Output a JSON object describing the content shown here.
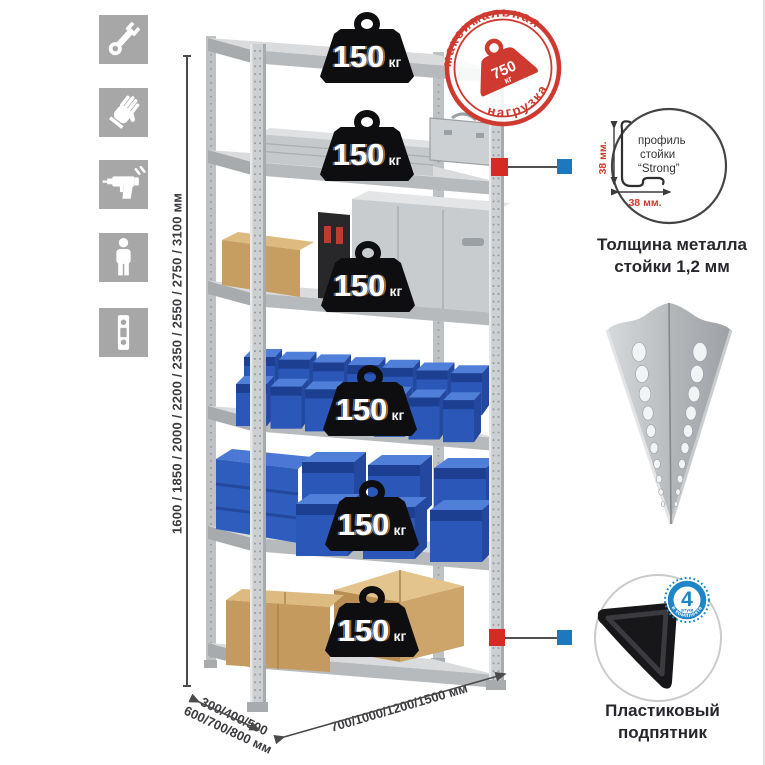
{
  "left_toolbar": {
    "icons": [
      "wrench",
      "gloves",
      "drill",
      "person",
      "level"
    ]
  },
  "height_dimension": {
    "label": "1600 / 1850 / 2000 / 2200 / 2350 / 2550 / 2750 / 3100 мм"
  },
  "depth_dimension": {
    "line1": "300/400/500",
    "line2": "600/700/800 мм"
  },
  "width_dimension": {
    "label": "700/1000/1200/1500 мм"
  },
  "max_load_stamp": {
    "arc_top": "максимальная",
    "arc_bottom": "нагрузка",
    "value": "750",
    "unit": "кг",
    "color": "#cf3a30"
  },
  "shelf_badges": [
    {
      "value": "150",
      "unit": "кг"
    },
    {
      "value": "150",
      "unit": "кг"
    },
    {
      "value": "150",
      "unit": "кг"
    },
    {
      "value": "150",
      "unit": "кг"
    },
    {
      "value": "150",
      "unit": "кг"
    },
    {
      "value": "150",
      "unit": "кг"
    }
  ],
  "post_profile": {
    "label_line1": "профиль",
    "label_line2": "стойки",
    "label_line3": "“Strong”",
    "dim_height": "38 мм.",
    "dim_width": "38 мм.",
    "caption_line1": "Толщина металла",
    "caption_line2": "стойки 1,2 мм"
  },
  "foot": {
    "count": "4",
    "count_note": "штуки",
    "arc_label": "в комплекте",
    "caption_line1": "Пластиковый",
    "caption_line2": "подпятник",
    "badge_color": "#1e86c6"
  },
  "colors": {
    "stamp_red": "#cf3a30",
    "connector_red": "#d62b22",
    "connector_blue": "#1c78bf",
    "bin_blue": "#2b57b8",
    "metal_gray": "#c6c9cb",
    "cardboard": "#c79e62",
    "icon_tile_gray": "#a7a7a7"
  }
}
